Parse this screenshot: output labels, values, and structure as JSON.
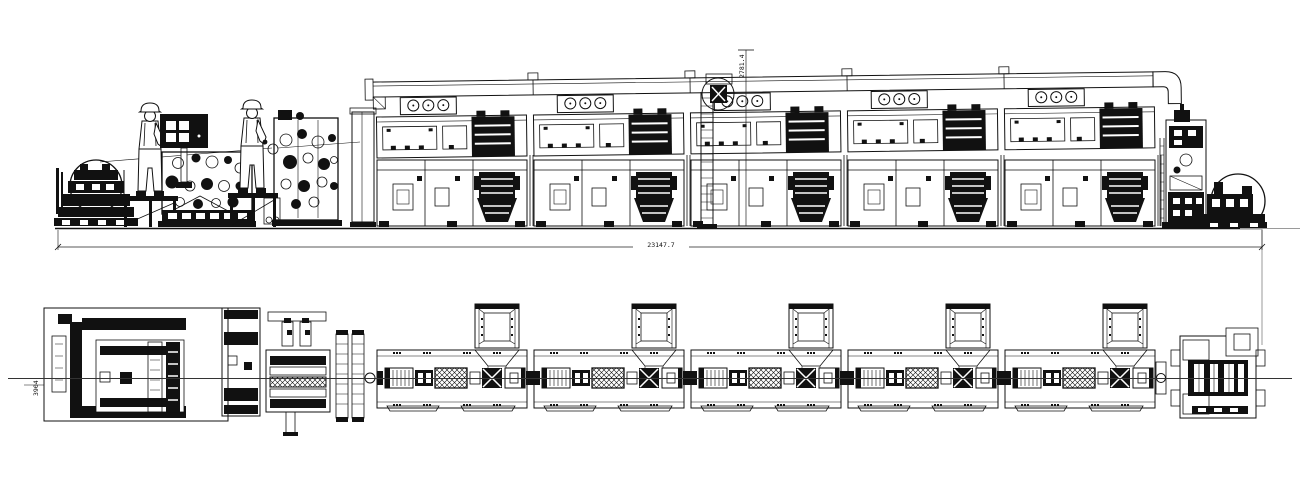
{
  "dims": {
    "overall_length": "23147.7",
    "height": "2781.4",
    "web_width": "3904"
  },
  "modules": {
    "count": 5
  },
  "colors": {
    "ink": "#111111",
    "background": "#ffffff",
    "construction": "#9a9a9a"
  }
}
